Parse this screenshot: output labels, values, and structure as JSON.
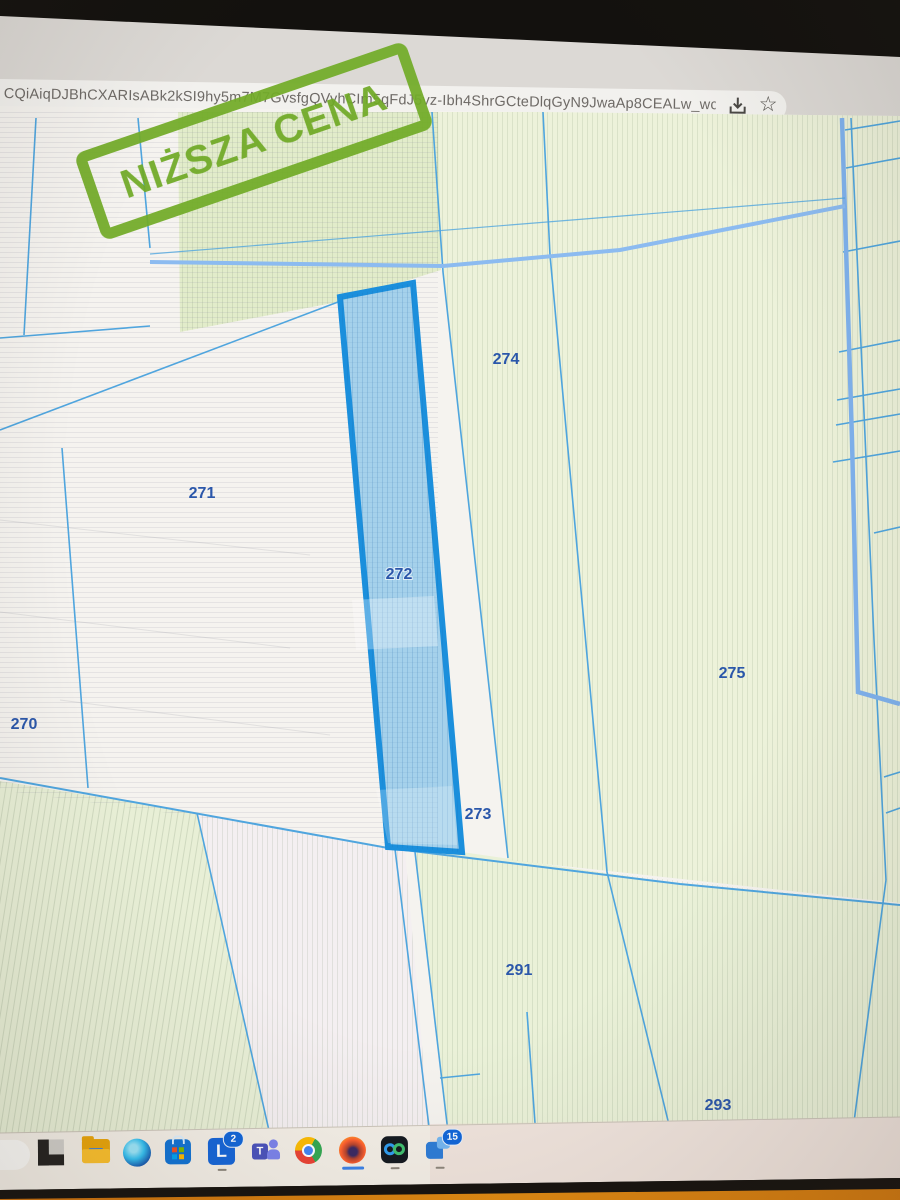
{
  "browser": {
    "url": "CQiAiqDJBhCXARIsABk2kSI9hy5m7M7GvsfgQVyhCIm5qFdJ5vz-Ibh4ShrGCteDlqGyN9JwaAp8CEALw_wcB",
    "star_glyph": "☆"
  },
  "stamp": {
    "text": "NIŻSZA CENA",
    "color": "#72ac28"
  },
  "map": {
    "highlighted_parcel": "272",
    "boundary_color": "#4fa5de",
    "highlight_border_color": "#1b8fdc",
    "parcels": [
      {
        "id": "270"
      },
      {
        "id": "271"
      },
      {
        "id": "272"
      },
      {
        "id": "273"
      },
      {
        "id": "274"
      },
      {
        "id": "275"
      },
      {
        "id": "291"
      },
      {
        "id": "293"
      }
    ]
  },
  "taskbar": {
    "lex_glyph": "L",
    "teams_glyph": "T",
    "lex_badge": "2",
    "chat_badge": "15"
  }
}
